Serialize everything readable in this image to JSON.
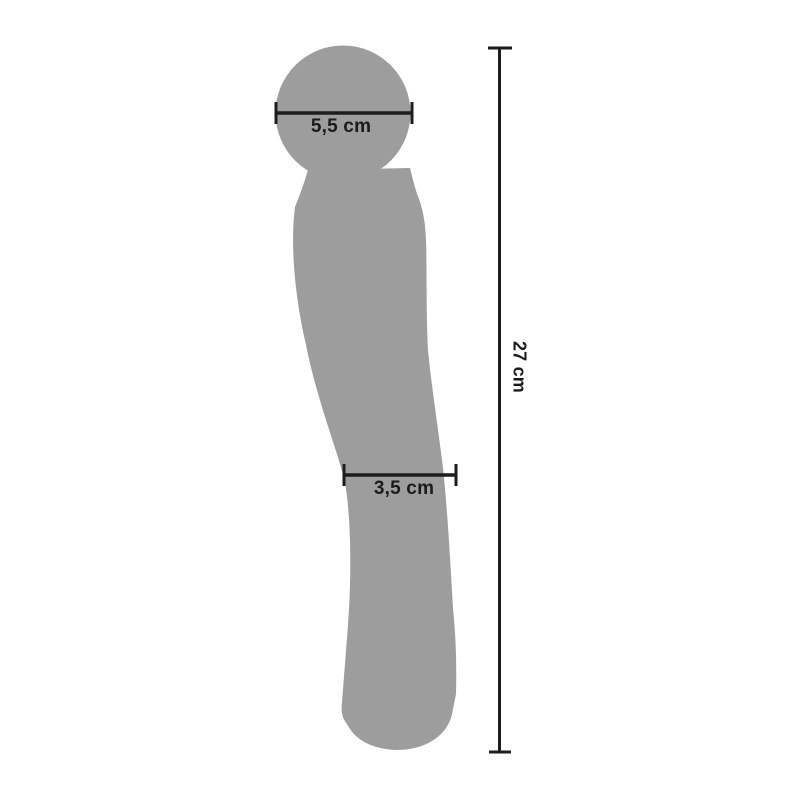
{
  "diagram": {
    "type": "product-dimension-diagram",
    "measurements": {
      "head_width": "5,5 cm",
      "shaft_width": "3,5 cm",
      "total_length": "27 cm"
    },
    "colors": {
      "silhouette": "#9d9d9d",
      "dimension_line": "#1d1d1d",
      "label_text": "#1b1b1b",
      "background": "#ffffff"
    }
  }
}
